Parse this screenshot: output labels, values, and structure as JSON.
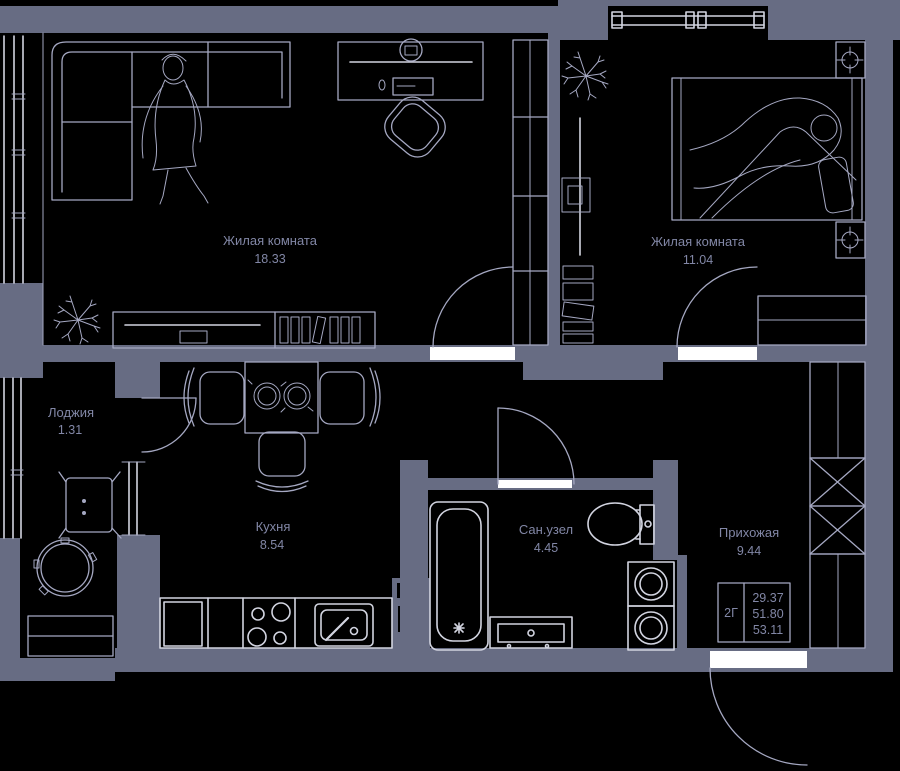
{
  "plan": {
    "rooms": [
      {
        "name": "Жилая комната",
        "area": "18.33"
      },
      {
        "name": "Жилая комната",
        "area": "11.04"
      },
      {
        "name": "Кухня",
        "area": "8.54"
      },
      {
        "name": "Сан.узел",
        "area": "4.45"
      },
      {
        "name": "Прихожая",
        "area": "9.44"
      },
      {
        "name": "Лоджия",
        "area": "1.31"
      }
    ],
    "legend": {
      "flat_type": "2Г",
      "area_living": "29.37",
      "area_main": "51.80",
      "area_total": "53.11"
    },
    "colors": {
      "background": "#000000",
      "wall": "#676c83",
      "line": "#a5a8c2",
      "bright": "#d2d4e0",
      "text": "#8287a6",
      "threshold": "#ffffff"
    }
  }
}
